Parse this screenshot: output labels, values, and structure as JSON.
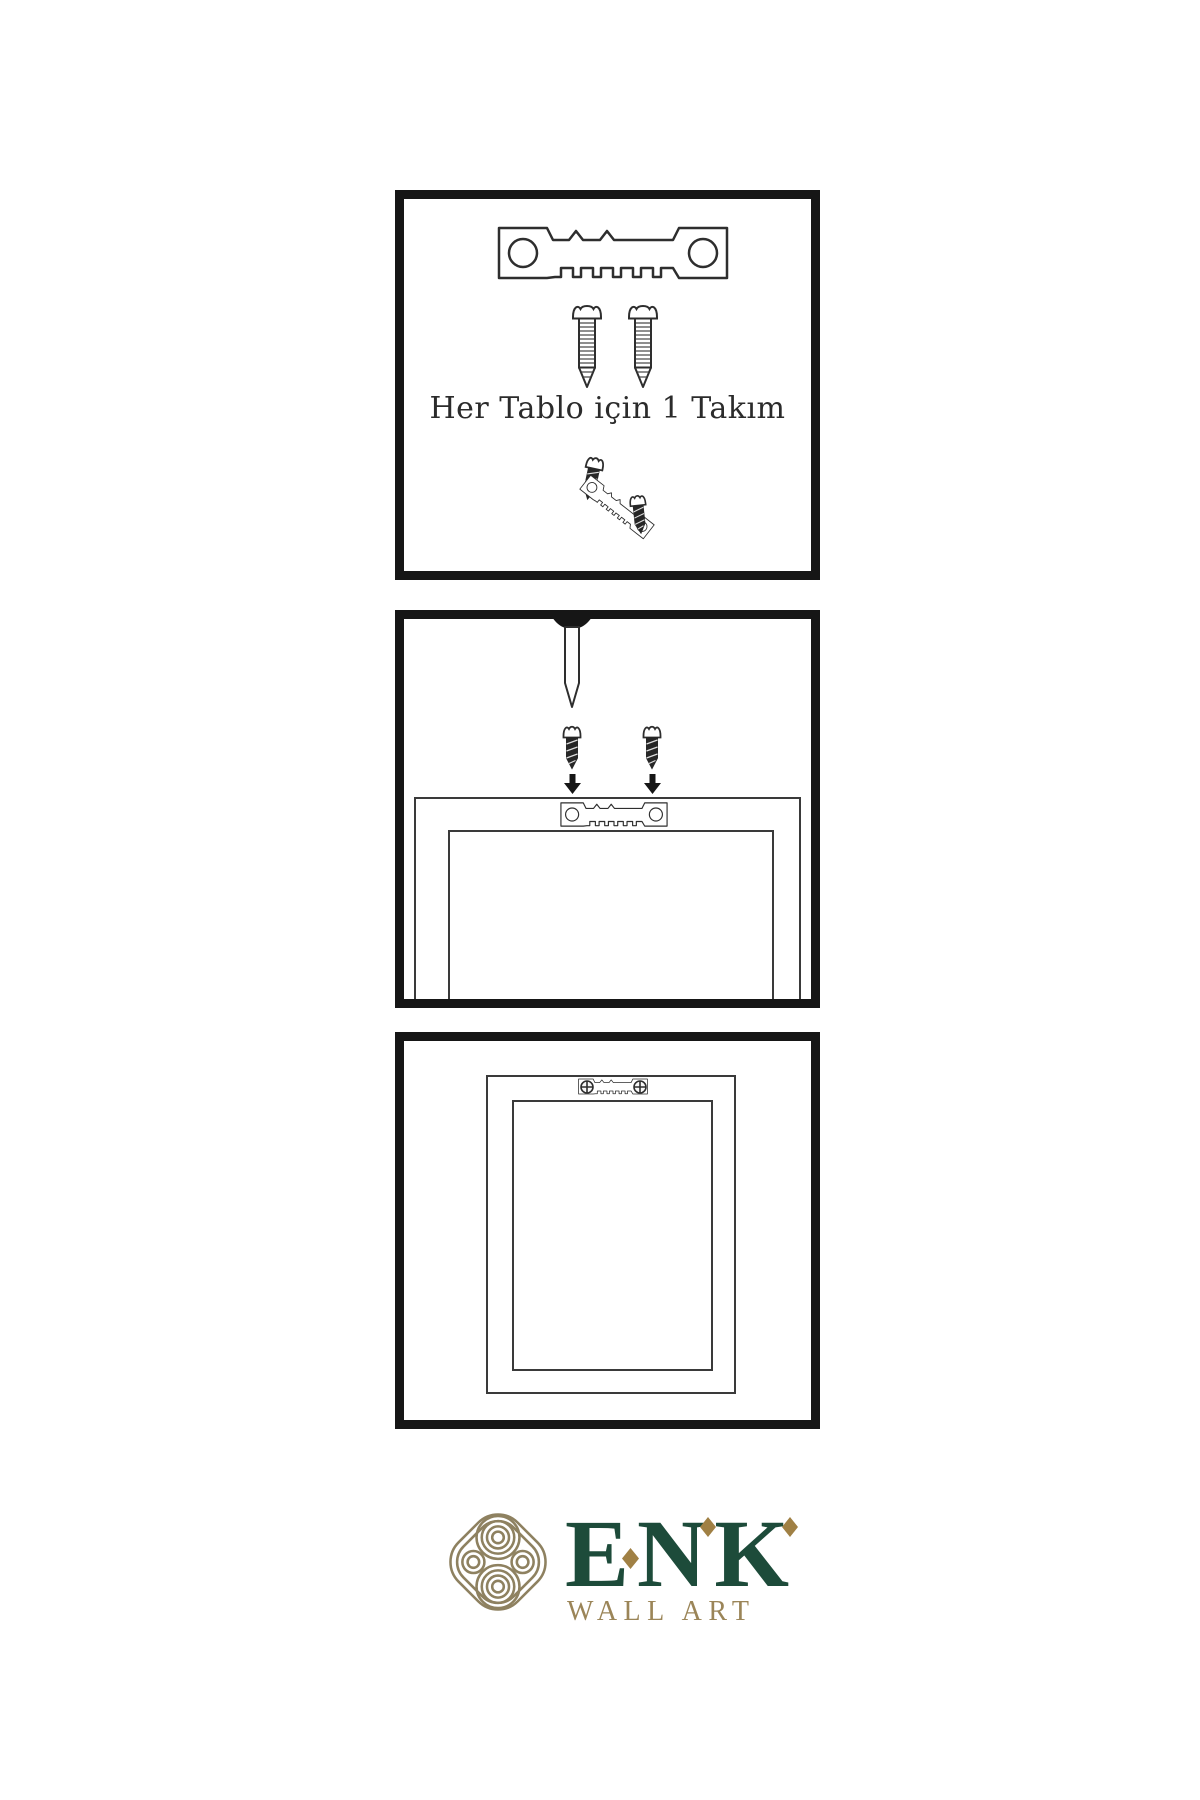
{
  "instructions": {
    "step1": {
      "caption": "Her Tablo için 1 Takım",
      "icons": [
        "sawtooth-hanger-icon",
        "screw-icon",
        "screw-icon",
        "angled-hanger-with-screws-icon"
      ]
    },
    "step2": {
      "icons": [
        "nail-icon",
        "dark-screw-icon",
        "dark-screw-icon",
        "down-arrow-icon",
        "down-arrow-icon",
        "frame-back-icon",
        "sawtooth-hanger-icon"
      ]
    },
    "step3": {
      "icons": [
        "frame-back-icon",
        "mounted-sawtooth-hanger-icon",
        "phillips-screw-head-icon",
        "phillips-screw-head-icon"
      ]
    }
  },
  "brand": {
    "name": "ENK",
    "tagline": "WALL ART",
    "logo_icon": "interlocked-knot-logo-icon"
  },
  "colors": {
    "page_background": "#ffffff",
    "panel_border": "#161616",
    "line_art": "#2e2e2e",
    "brand_green": "#1d4b3a",
    "brand_gold": "#a08044",
    "brand_khaki": "#8e8160",
    "tagline_gold": "#9b8558"
  }
}
